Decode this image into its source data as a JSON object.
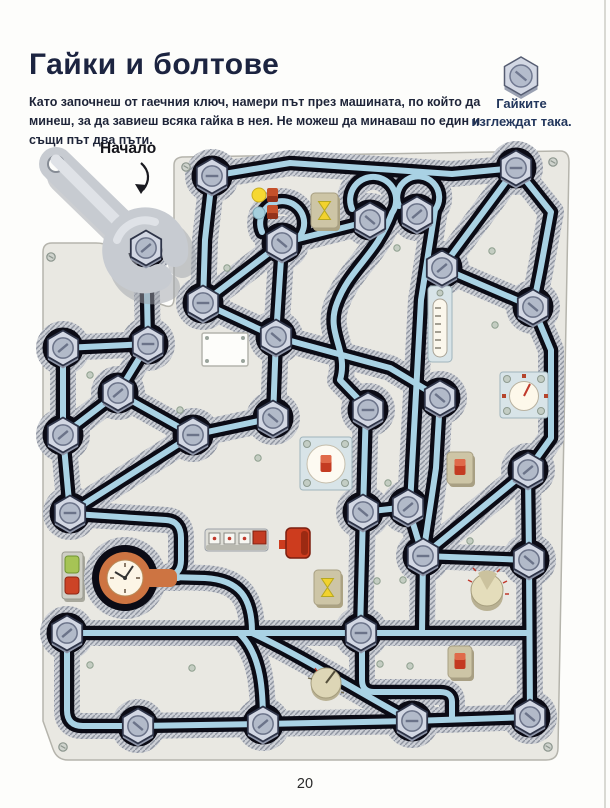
{
  "page": {
    "title": "Гайки и болтове",
    "instructions": "Като започнеш от гаечния ключ, намери път през машината, по който да минеш, за да завиеш всяка гайка в нея. Не можеш да минаваш по един и същи път два пъти.",
    "start_label": "Начало",
    "page_number": "20"
  },
  "legend": {
    "line1": "Гайките",
    "line2": "изглеждат така."
  },
  "colors": {
    "title": "#1c2440",
    "body_text": "#1e2438",
    "caption": "#22365c",
    "start_label": "#15151b",
    "page_number": "#2a2a2a",
    "plate": "#e9e8e2",
    "plate_outline": "#b5b4ac",
    "channel": "#0b0b15",
    "track": "#a9d2e4",
    "rim": "#cdd0d6",
    "nut_face": "#d2d7e3",
    "nut_side": "#8e95a8",
    "clock_orange": "#cd7442",
    "switch_red": "#c43b22",
    "toggle_yellow": "#f2d22e",
    "button_green": "#a6c455",
    "panel_blue": "#d8e4e8",
    "panel_tan": "#cdc5a6"
  }
}
